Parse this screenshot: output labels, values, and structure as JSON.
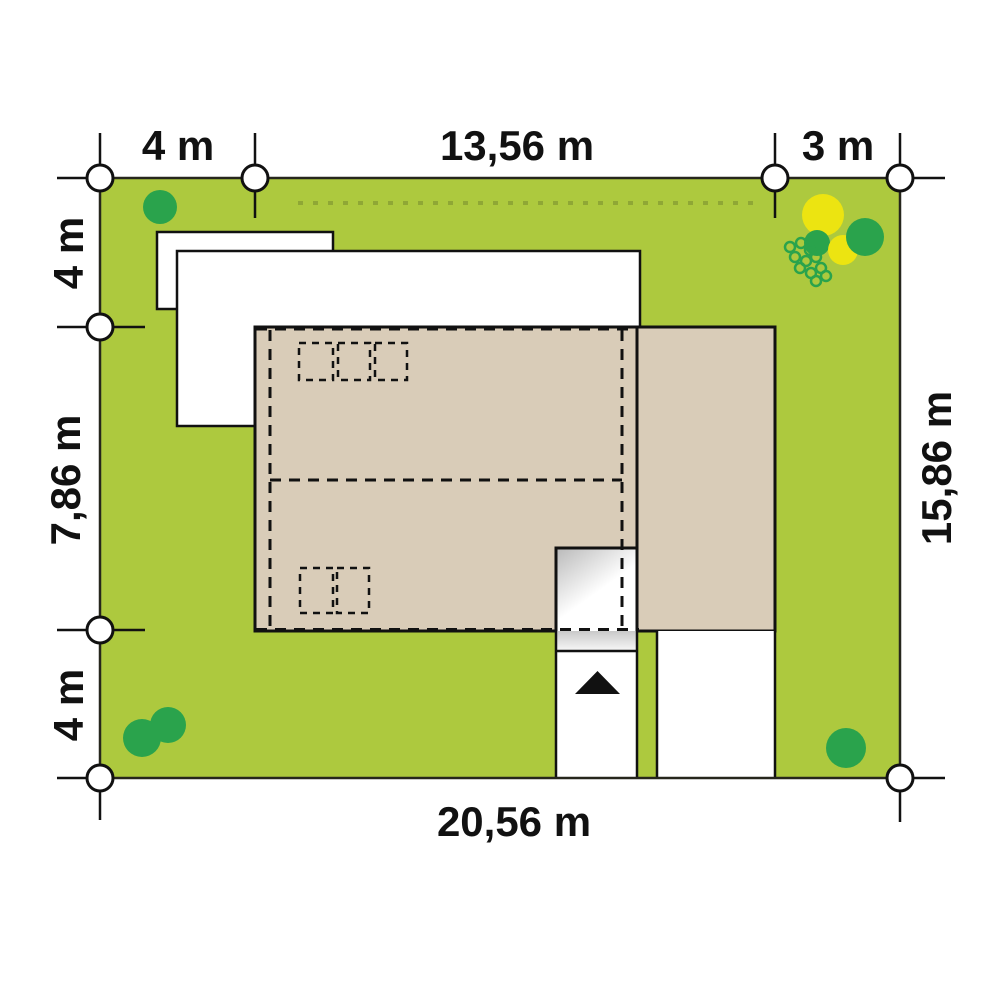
{
  "plan": {
    "type": "house-site-plan",
    "dimensions": {
      "top": [
        {
          "label": "4 m"
        },
        {
          "label": "13,56 m"
        },
        {
          "label": "3 m"
        }
      ],
      "left": [
        {
          "label": "4 m"
        },
        {
          "label": "7,86 m"
        },
        {
          "label": "4 m"
        }
      ],
      "right": [
        {
          "label": "15,86 m"
        }
      ],
      "bottom": [
        {
          "label": "20,56 m"
        }
      ]
    },
    "colors": {
      "grass": "#adc93e",
      "building_line_dots": "#8fa735",
      "roof": "#d9ccb8",
      "tree_green": "#2aa34c",
      "tree_yellow": "#ece411",
      "outline": "#111111",
      "paving": "#ffffff",
      "shadow": "#bdbdbd"
    },
    "icons": {
      "entrance_arrow": "▲"
    }
  }
}
